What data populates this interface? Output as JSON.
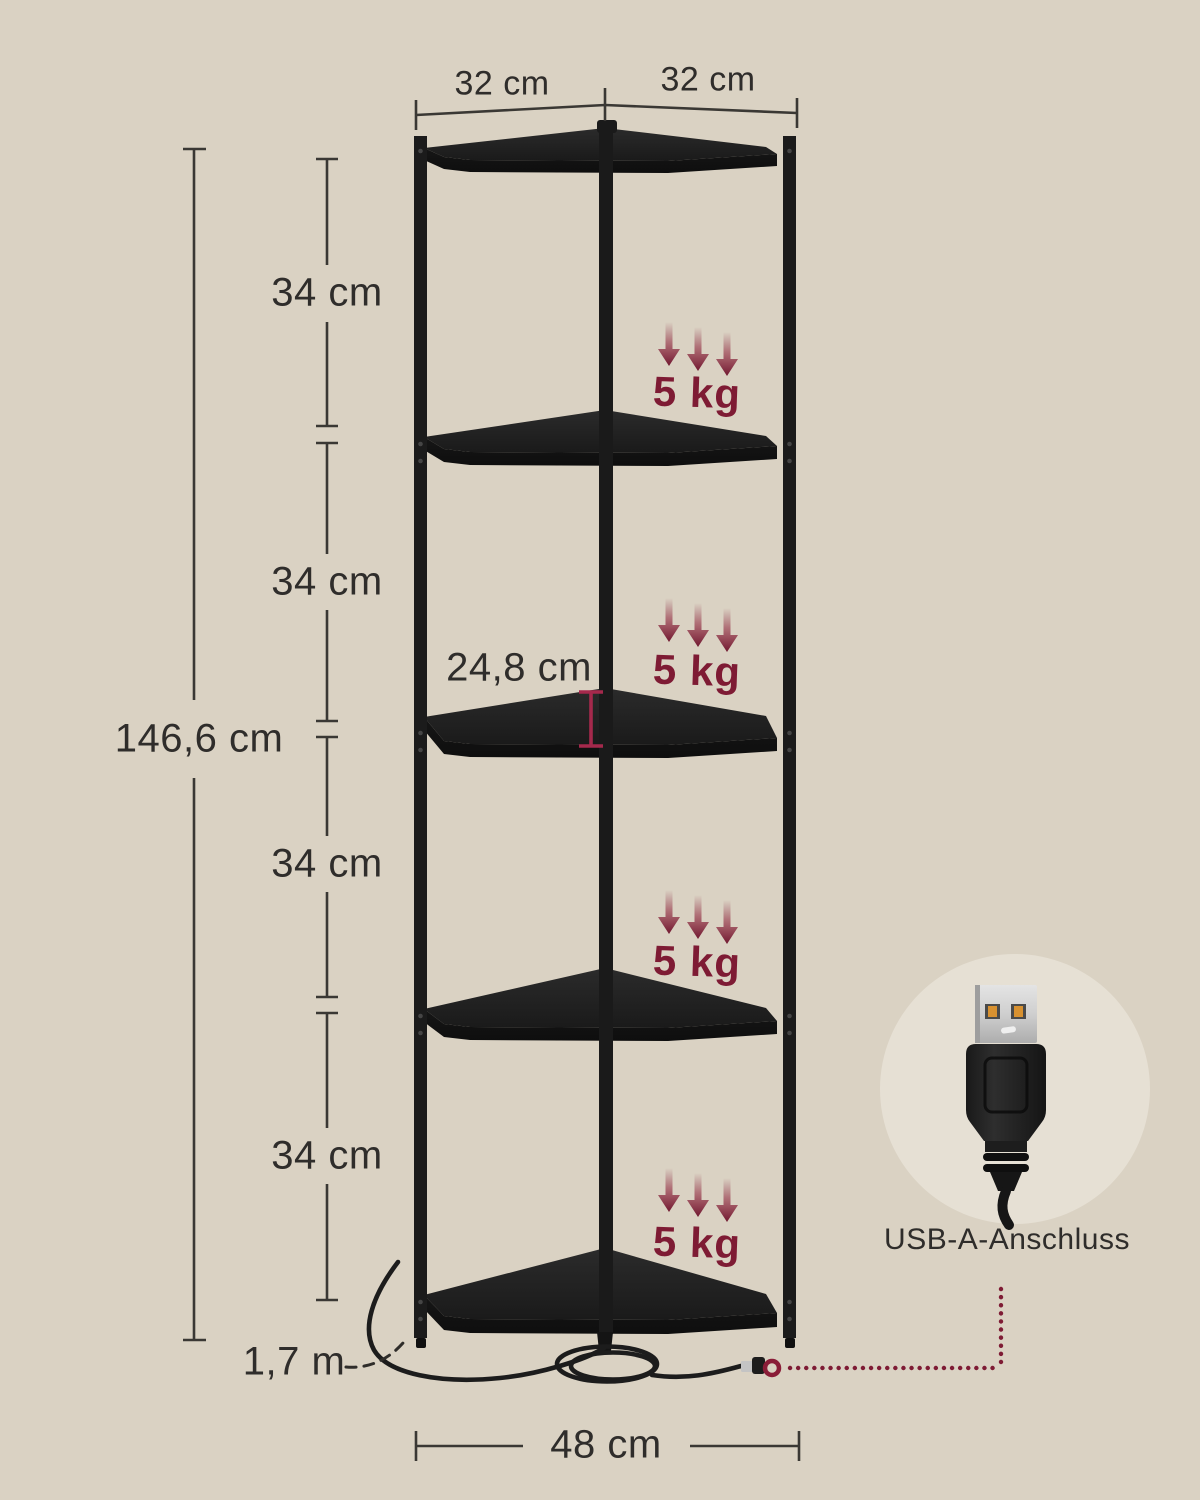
{
  "page": {
    "background_color": "#DAD2C3",
    "subject": "corner shelf with 5 tiers and charging station - dimension diagram"
  },
  "colors": {
    "ink": "#2F2D2B",
    "accent_red": "#7E1B34",
    "depth_marker_red": "#A5294C",
    "shelf_black": "#1E1E1E",
    "callout_circle_bg": "#E6E0D4"
  },
  "dimensions": {
    "top_left_width": "32 cm",
    "top_right_width": "32 cm",
    "total_height": "146,6 cm",
    "tier_spacing": [
      "34 cm",
      "34 cm",
      "34 cm",
      "34 cm"
    ],
    "shelf_depth": "24,8 cm",
    "base_width": "48 cm",
    "cable_length": "1,7 m"
  },
  "load_capacity": {
    "labels": [
      "5 kg",
      "5 kg",
      "5 kg",
      "5 kg"
    ]
  },
  "usb_callout": {
    "label": "USB-A-Anschluss"
  },
  "icons": {
    "load_arrows": "triple-down-arrow-icon",
    "usb_plug": "usb-a-plug-icon",
    "connector_marker": "ring-marker-icon",
    "power_cable": "coiled-cable-icon"
  }
}
